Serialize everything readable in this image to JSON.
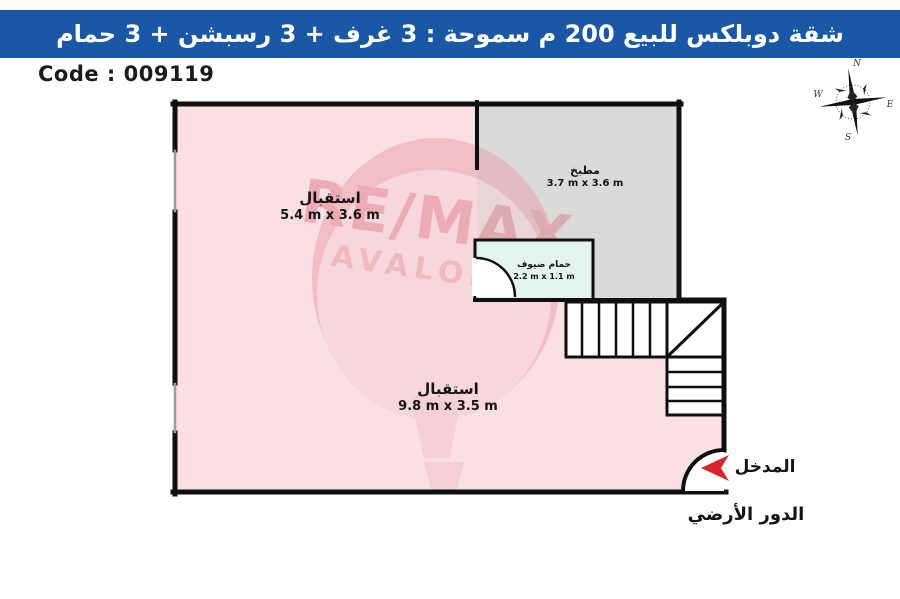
{
  "header": {
    "title": "شقة دوبلكس للبيع 200 م سموحة :  3 غرف + 3 رسبشن + 3 حمام"
  },
  "code": {
    "label": "Code : 009119"
  },
  "compass": {
    "north": "N",
    "east": "E",
    "south": "S",
    "west": "W"
  },
  "watermark": {
    "line1": "RE/MAX",
    "line2": "AVALONA"
  },
  "plan": {
    "rooms": [
      {
        "name": "استقبال",
        "dims": "5.4 m x 3.6 m"
      },
      {
        "name": "مطبخ",
        "dims": "3.7 m x 3.6 m"
      },
      {
        "name": "حمام ضيوف",
        "dims": "2.2 m x 1.1 m"
      },
      {
        "name": "استقبال",
        "dims": "9.8 m x 3.5 m"
      }
    ],
    "entrance_label": "المدخل",
    "floor_label": "الدور الأرضي"
  },
  "colors": {
    "header_bg": "#1a57a5",
    "room_pink": "#fadfe4",
    "kitchen_gray": "#dbdad8",
    "bath_cyan": "#e2f3f0",
    "wall": "#0f0f0f",
    "arrow_red": "#d6252b"
  }
}
